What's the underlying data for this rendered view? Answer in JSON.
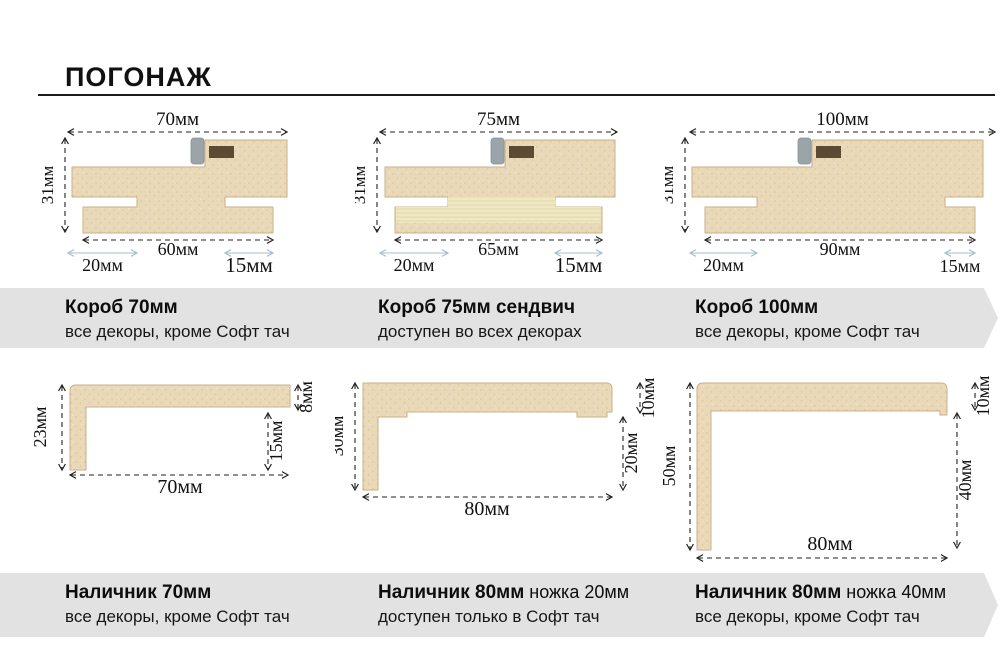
{
  "title": "ПОГОНАЖ",
  "colors": {
    "wood": "#ead9b9",
    "wood_speckle": "#d9c294",
    "wood_border": "#c9b187",
    "sandwich_base": "#f2ecca",
    "sandwich_stripe": "#ded2a0",
    "gasket": "#9ba5a9",
    "slot": "#5c4a33",
    "band_bg": "#e2e2e2",
    "dim_line": "#222222",
    "blue_arrow": "#a2bfd0"
  },
  "diagrams": [
    {
      "kind": "korob",
      "label": "Короб 70мм",
      "dims": {
        "top": "70мм",
        "left": "31мм",
        "bottom": "60мм",
        "left_notch": "20мм",
        "right_notch": "15мм"
      }
    },
    {
      "kind": "korob",
      "label": "Короб 75мм сендвич",
      "dims": {
        "top": "75мм",
        "left": "31мм",
        "bottom": "65мм",
        "left_notch": "20мм",
        "right_notch": "15мм"
      }
    },
    {
      "kind": "korob",
      "label": "Короб 100мм",
      "dims": {
        "top": "100мм",
        "left": "31мм",
        "bottom": "90мм",
        "left_notch": "20мм",
        "right_notch": "15мм"
      }
    },
    {
      "kind": "nalichnik",
      "label": "Наличник 70мм",
      "dims": {
        "left": "23мм",
        "thickness": "8мм",
        "leg": "15мм",
        "bottom": "70мм"
      }
    },
    {
      "kind": "nalichnik",
      "label": "Наличник 80мм ножка 20мм",
      "dims": {
        "left": "30мм",
        "thickness": "10мм",
        "leg": "20мм",
        "bottom": "80мм"
      }
    },
    {
      "kind": "nalichnik",
      "label": "Наличник 80мм ножка 40мм",
      "dims": {
        "left": "50мм",
        "thickness": "10мм",
        "leg": "40мм",
        "bottom": "80мм"
      }
    }
  ],
  "bands": [
    {
      "items": [
        {
          "title": "Короб 70мм",
          "suffix": "",
          "desc": "все декоры, кроме Софт тач"
        },
        {
          "title": "Короб 75мм сендвич",
          "suffix": "",
          "desc": "доступен во всех декорах"
        },
        {
          "title": "Короб 100мм",
          "suffix": "",
          "desc": "все декоры, кроме Софт тач"
        }
      ]
    },
    {
      "items": [
        {
          "title": "Наличник 70мм",
          "suffix": "",
          "desc": "все декоры, кроме Софт тач"
        },
        {
          "title": "Наличник 80мм",
          "suffix": " ножка 20мм",
          "desc": "доступен только в Софт тач"
        },
        {
          "title": "Наличник 80мм",
          "suffix": " ножка 40мм",
          "desc": "все декоры, кроме Софт тач"
        }
      ]
    }
  ]
}
